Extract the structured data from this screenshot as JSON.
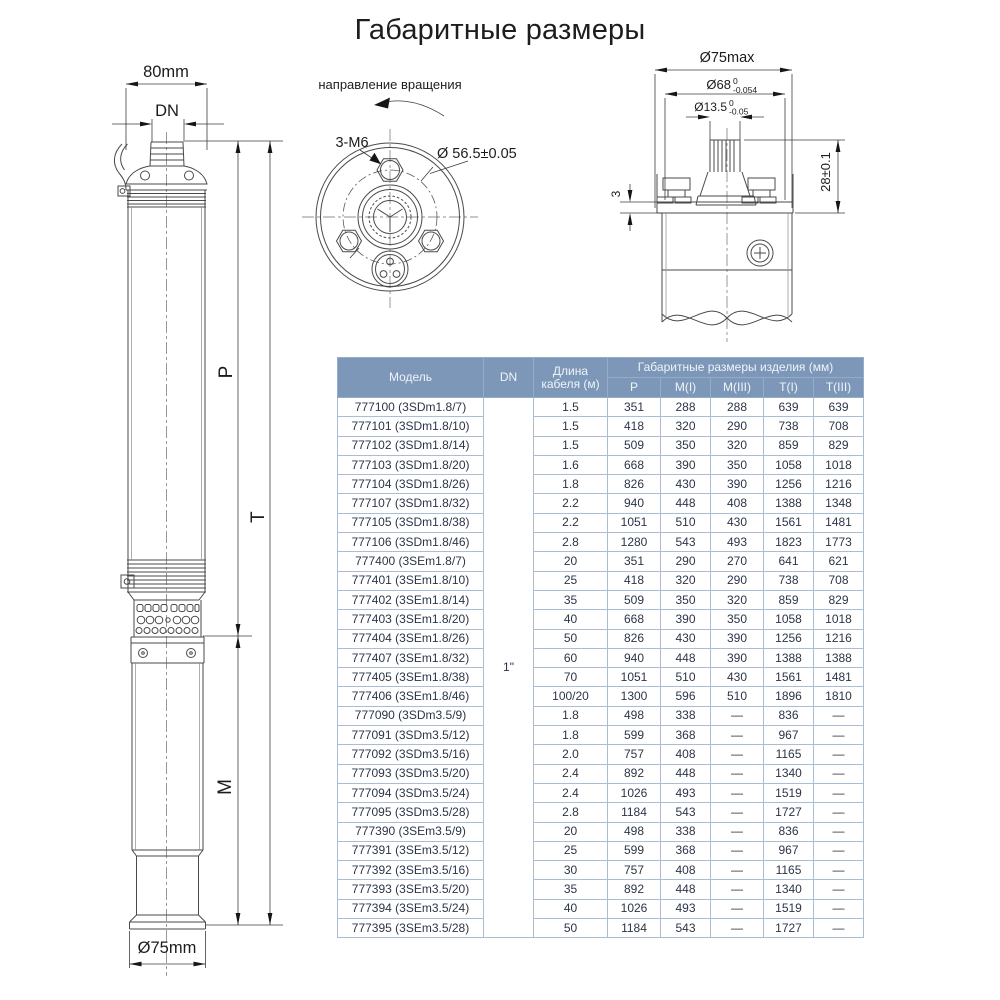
{
  "title": "Габаритные размеры",
  "side_view": {
    "dim_width_top": "80mm",
    "dim_outlet": "DN",
    "label_p": "P",
    "label_t": "T",
    "label_m": "M",
    "dim_diameter_bottom": "Ø75mm"
  },
  "top_view": {
    "rotation_label": "направление вращения",
    "thread_label": "3-M6",
    "pitch_circle": "Ø 56.5±0.05"
  },
  "coupling_view": {
    "dim_outer": "Ø75max",
    "dim_spigot": "Ø68",
    "spigot_tol_top": "0",
    "spigot_tol_bottom": "-0.054",
    "dim_shaft": "Ø13.5",
    "shaft_tol_top": "0",
    "shaft_tol_bottom": "-0.05",
    "dim_height": "28±0.1",
    "dim_step": "3"
  },
  "table": {
    "col_model": "Модель",
    "col_dn": "DN",
    "col_cable": "Длина кабеля (м)",
    "col_group": "Габаритные размеры изделия (мм)",
    "sub_cols": [
      "P",
      "M(I)",
      "M(III)",
      "T(I)",
      "T(III)"
    ],
    "dn_value": "1\"",
    "rows": [
      {
        "model": "777100 (3SDm1.8/7)",
        "cable": "1.5",
        "p": "351",
        "mi": "288",
        "miii": "288",
        "ti": "639",
        "tiii": "639"
      },
      {
        "model": "777101 (3SDm1.8/10)",
        "cable": "1.5",
        "p": "418",
        "mi": "320",
        "miii": "290",
        "ti": "738",
        "tiii": "708"
      },
      {
        "model": "777102 (3SDm1.8/14)",
        "cable": "1.5",
        "p": "509",
        "mi": "350",
        "miii": "320",
        "ti": "859",
        "tiii": "829"
      },
      {
        "model": "777103 (3SDm1.8/20)",
        "cable": "1.6",
        "p": "668",
        "mi": "390",
        "miii": "350",
        "ti": "1058",
        "tiii": "1018"
      },
      {
        "model": "777104 (3SDm1.8/26)",
        "cable": "1.8",
        "p": "826",
        "mi": "430",
        "miii": "390",
        "ti": "1256",
        "tiii": "1216"
      },
      {
        "model": "777107 (3SDm1.8/32)",
        "cable": "2.2",
        "p": "940",
        "mi": "448",
        "miii": "408",
        "ti": "1388",
        "tiii": "1348"
      },
      {
        "model": "777105 (3SDm1.8/38)",
        "cable": "2.2",
        "p": "1051",
        "mi": "510",
        "miii": "430",
        "ti": "1561",
        "tiii": "1481"
      },
      {
        "model": "777106 (3SDm1.8/46)",
        "cable": "2.8",
        "p": "1280",
        "mi": "543",
        "miii": "493",
        "ti": "1823",
        "tiii": "1773"
      },
      {
        "model": "777400 (3SEm1.8/7)",
        "cable": "20",
        "p": "351",
        "mi": "290",
        "miii": "270",
        "ti": "641",
        "tiii": "621"
      },
      {
        "model": "777401 (3SEm1.8/10)",
        "cable": "25",
        "p": "418",
        "mi": "320",
        "miii": "290",
        "ti": "738",
        "tiii": "708"
      },
      {
        "model": "777402 (3SEm1.8/14)",
        "cable": "35",
        "p": "509",
        "mi": "350",
        "miii": "320",
        "ti": "859",
        "tiii": "829"
      },
      {
        "model": "777403 (3SEm1.8/20)",
        "cable": "40",
        "p": "668",
        "mi": "390",
        "miii": "350",
        "ti": "1058",
        "tiii": "1018"
      },
      {
        "model": "777404 (3SEm1.8/26)",
        "cable": "50",
        "p": "826",
        "mi": "430",
        "miii": "390",
        "ti": "1256",
        "tiii": "1216"
      },
      {
        "model": "777407 (3SEm1.8/32)",
        "cable": "60",
        "p": "940",
        "mi": "448",
        "miii": "390",
        "ti": "1388",
        "tiii": "1388"
      },
      {
        "model": "777405 (3SEm1.8/38)",
        "cable": "70",
        "p": "1051",
        "mi": "510",
        "miii": "430",
        "ti": "1561",
        "tiii": "1481"
      },
      {
        "model": "777406 (3SEm1.8/46)",
        "cable": "100/20",
        "p": "1300",
        "mi": "596",
        "miii": "510",
        "ti": "1896",
        "tiii": "1810"
      },
      {
        "model": "777090 (3SDm3.5/9)",
        "cable": "1.8",
        "p": "498",
        "mi": "338",
        "miii": "—",
        "ti": "836",
        "tiii": "—"
      },
      {
        "model": "777091 (3SDm3.5/12)",
        "cable": "1.8",
        "p": "599",
        "mi": "368",
        "miii": "—",
        "ti": "967",
        "tiii": "—"
      },
      {
        "model": "777092 (3SDm3.5/16)",
        "cable": "2.0",
        "p": "757",
        "mi": "408",
        "miii": "—",
        "ti": "1165",
        "tiii": "—"
      },
      {
        "model": "777093 (3SDm3.5/20)",
        "cable": "2.4",
        "p": "892",
        "mi": "448",
        "miii": "—",
        "ti": "1340",
        "tiii": "—"
      },
      {
        "model": "777094 (3SDm3.5/24)",
        "cable": "2.4",
        "p": "1026",
        "mi": "493",
        "miii": "—",
        "ti": "1519",
        "tiii": "—"
      },
      {
        "model": "777095 (3SDm3.5/28)",
        "cable": "2.8",
        "p": "1184",
        "mi": "543",
        "miii": "—",
        "ti": "1727",
        "tiii": "—"
      },
      {
        "model": "777390 (3SEm3.5/9)",
        "cable": "20",
        "p": "498",
        "mi": "338",
        "miii": "—",
        "ti": "836",
        "tiii": "—"
      },
      {
        "model": "777391 (3SEm3.5/12)",
        "cable": "25",
        "p": "599",
        "mi": "368",
        "miii": "—",
        "ti": "967",
        "tiii": "—"
      },
      {
        "model": "777392 (3SEm3.5/16)",
        "cable": "30",
        "p": "757",
        "mi": "408",
        "miii": "—",
        "ti": "1165",
        "tiii": "—"
      },
      {
        "model": "777393 (3SEm3.5/20)",
        "cable": "35",
        "p": "892",
        "mi": "448",
        "miii": "—",
        "ti": "1340",
        "tiii": "—"
      },
      {
        "model": "777394 (3SEm3.5/24)",
        "cable": "40",
        "p": "1026",
        "mi": "493",
        "miii": "—",
        "ti": "1519",
        "tiii": "—"
      },
      {
        "model": "777395 (3SEm3.5/28)",
        "cable": "50",
        "p": "1184",
        "mi": "543",
        "miii": "—",
        "ti": "1727",
        "tiii": "—"
      }
    ]
  },
  "colors": {
    "header_bg": "#7d97b8",
    "header_text": "#eff4f9",
    "grid": "#a9bed5",
    "cell_text": "#2b3547"
  }
}
